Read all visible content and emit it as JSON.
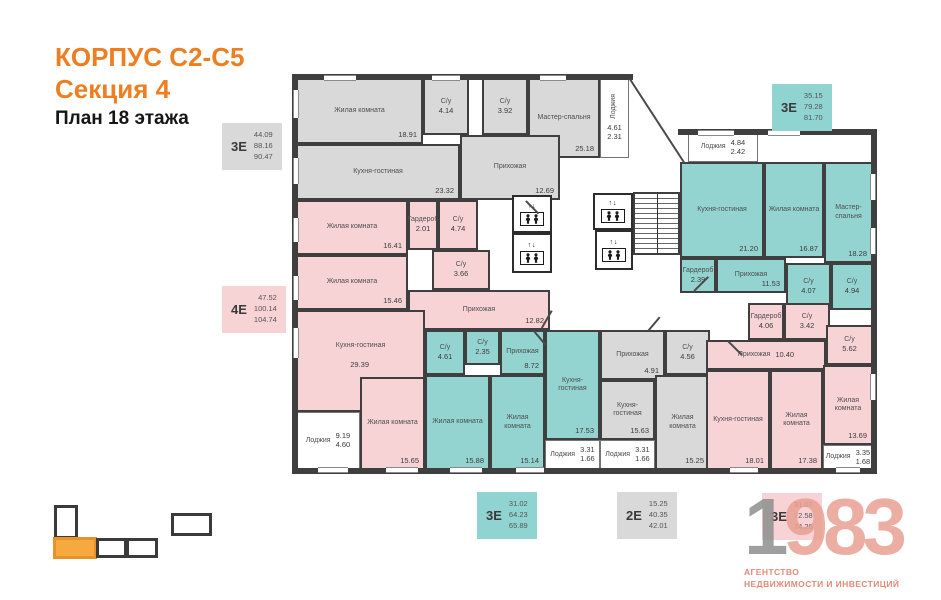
{
  "header": {
    "building": "КОРПУС С2-С5",
    "section": "Секция 4",
    "floor_plan": "План 18 этажа"
  },
  "plan": {
    "elevator_arrows": "↑↓",
    "rooms": [
      {
        "name": "Жилая комната",
        "area": "18.91"
      },
      {
        "name": "С/у",
        "area": "4.14"
      },
      {
        "name": "С/у",
        "area": "3.92"
      },
      {
        "name": "Мастер-спальня",
        "area": "25.18"
      },
      {
        "name": "Лоджия",
        "area": "4.61",
        "area2": "2.31"
      },
      {
        "name": "Кухня-гостиная",
        "area": "23.32"
      },
      {
        "name": "Прихожая",
        "area": "12.69"
      },
      {
        "name": "Жилая комната",
        "area": "16.41"
      },
      {
        "name": "Гардероб",
        "area": "2.01"
      },
      {
        "name": "С/у",
        "area": "4.74"
      },
      {
        "name": "Жилая комната",
        "area": "15.46"
      },
      {
        "name": "С/у",
        "area": "3.66"
      },
      {
        "name": "Прихожая",
        "area": "12.82"
      },
      {
        "name": "Кухня-гостиная",
        "area": "29.39"
      },
      {
        "name": "Лоджия",
        "area": "9.19",
        "area2": "4.60"
      },
      {
        "name": "Жилая комната",
        "area": "15.65"
      },
      {
        "name": "С/у",
        "area": "4.61"
      },
      {
        "name": "С/у",
        "area": "2.35"
      },
      {
        "name": "Прихожая",
        "area": "8.72"
      },
      {
        "name": "Жилая комната",
        "area": "15.88"
      },
      {
        "name": "Жилая комната",
        "area": "15.14"
      },
      {
        "name": "Кухня-гостиная",
        "area": "17.53"
      },
      {
        "name": "Лоджия",
        "area": "3.31",
        "area2": "1.66"
      },
      {
        "name": "Прихожая",
        "area": "4.91"
      },
      {
        "name": "С/у",
        "area": "4.56"
      },
      {
        "name": "Кухня-гостиная",
        "area": "15.63"
      },
      {
        "name": "Жилая комната",
        "area": "15.25"
      },
      {
        "name": "Лоджия",
        "area": "3.31",
        "area2": "1.66"
      },
      {
        "name": "Лоджия",
        "area": "4.84",
        "area2": "2.42"
      },
      {
        "name": "Кухня-гостиная",
        "area": "21.20"
      },
      {
        "name": "Жилая комната",
        "area": "16.87"
      },
      {
        "name": "Мастер-спальня",
        "area": "18.28"
      },
      {
        "name": "Гардероб",
        "area": "2.39"
      },
      {
        "name": "Прихожая",
        "area": "11.53"
      },
      {
        "name": "С/у",
        "area": "4.07"
      },
      {
        "name": "С/у",
        "area": "4.94"
      },
      {
        "name": "Гардероб",
        "area": "4.06"
      },
      {
        "name": "С/у",
        "area": "3.42"
      },
      {
        "name": "С/у",
        "area": "5.62"
      },
      {
        "name": "Прихожая",
        "area": "10.40"
      },
      {
        "name": "Кухня-гостиная",
        "area": "18.01"
      },
      {
        "name": "Жилая комната",
        "area": "17.38"
      },
      {
        "name": "Жилая комната",
        "area": "13.69"
      },
      {
        "name": "Лоджия",
        "area": "3.35",
        "area2": "1.68"
      }
    ]
  },
  "badges": {
    "left_top_3e": {
      "code": "3Е",
      "values": [
        "44.09",
        "88.16",
        "90.47"
      ]
    },
    "left_mid_4e": {
      "code": "4Е",
      "values": [
        "47.52",
        "100.14",
        "104.74"
      ]
    },
    "top_right_3e": {
      "code": "3Е",
      "values": [
        "35.15",
        "79.28",
        "81.70"
      ]
    },
    "bottom_teal_3e": {
      "code": "3Е",
      "values": [
        "31.02",
        "64.23",
        "65.89"
      ]
    },
    "bottom_gray_2e": {
      "code": "2Е",
      "values": [
        "15.25",
        "40.35",
        "42.01"
      ]
    },
    "bottom_pink_3e": {
      "code": "3Е",
      "values": [
        "31.07",
        "72.58",
        "74.26"
      ]
    }
  },
  "logo": {
    "digit_gray": "1",
    "digits_accent": "983",
    "tagline_line1": "АГЕНТСТВО",
    "tagline_line2": "НЕДВИЖИМОСТИ И ИНВЕСТИЦИЙ"
  },
  "colors": {
    "accent_orange": "#ee7e20",
    "apartment_gray": "#d9d9d9",
    "apartment_pink": "#f8d3d6",
    "apartment_teal": "#93d4d1",
    "wall": "#3f3f3f",
    "logo_salmon": "#e9a092"
  }
}
